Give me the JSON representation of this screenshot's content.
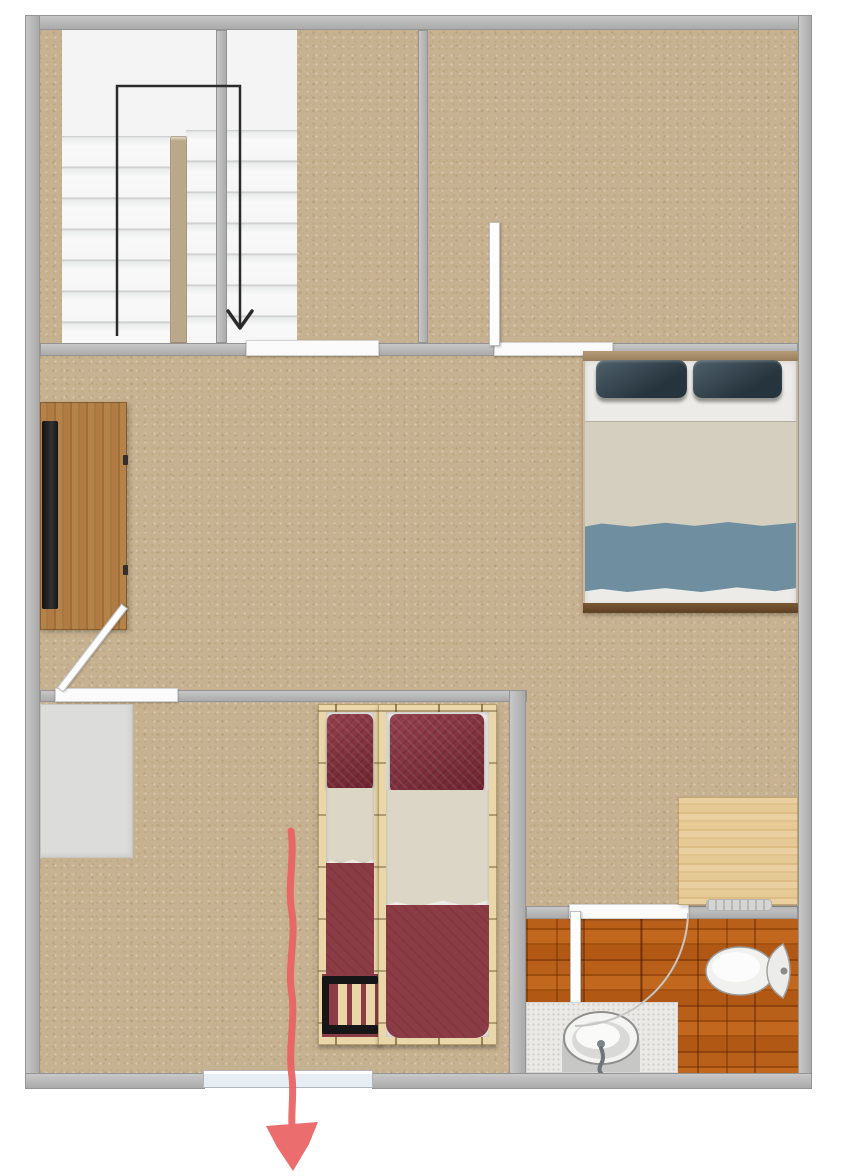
{
  "document": {
    "kind": "floor-plan",
    "view": "top-down",
    "visible_text": []
  },
  "colors": {
    "carpet": "#c6b190",
    "wall": "#b3b3b3",
    "wall_edge": "#949494",
    "stair_bg": "#f4f4f4",
    "stair_divider": "#bba888",
    "sill": "#fbfbfb",
    "window_glass": "#e6eef3",
    "closet": "#dcdcda",
    "desk_wood": "#b07d40",
    "tv": "#1d1d1d",
    "pine_desk": "#e6c893",
    "vent": "#d5d5d3",
    "bed_head": "#a98e6d",
    "bed_foot": "#6e4e2e",
    "mattress": "#ecebe7",
    "pillow_slate": "#37454e",
    "blanket_beige": "#d5cfc0",
    "blanket_blue": "#6f8fa0",
    "twin_frame": "#e9d7a9",
    "twin_pillow": "#82323d",
    "twin_sheet": "#dcd6c7",
    "twin_blanket": "#8b3c45",
    "ladder": "#161616",
    "bath_wood": "#ab5312",
    "counter": "#ebe9e5",
    "porcelain": "#efefed",
    "guide": "#2b2b2b",
    "arrow_red": "#ea6262"
  },
  "stairs": {
    "flights": 2,
    "treads_per_flight": 7,
    "shape": "U-return",
    "direction_arrow": "down"
  },
  "areas": [
    {
      "id": "staircase",
      "floor": "white"
    },
    {
      "id": "upper-hall",
      "floor": "carpet"
    },
    {
      "id": "bedroom-top-right",
      "floor": "carpet"
    },
    {
      "id": "central-living-area",
      "floor": "carpet"
    },
    {
      "id": "bedroom-bottom-twin",
      "floor": "carpet"
    },
    {
      "id": "bathroom",
      "floor": "wood-planks"
    }
  ],
  "doors": [
    {
      "id": "bedroom-top-door",
      "state": "open",
      "leaf": "shown"
    },
    {
      "id": "living-to-bottom-room-door",
      "state": "half-open-diagonal",
      "leaf": "shown"
    },
    {
      "id": "bathroom-door",
      "state": "open",
      "swing_arc_visible": true
    }
  ],
  "windows": [
    {
      "id": "south-window",
      "wall": "bottom"
    }
  ],
  "furniture": [
    {
      "id": "closet-wardrobe",
      "room": "bedroom-bottom-twin"
    },
    {
      "id": "tv-sideboard",
      "room": "central-living-area",
      "items_on_top": [
        "tv"
      ]
    },
    {
      "id": "double-bed",
      "room": "central-living-area",
      "pillows": 2,
      "pillow_color_ref": "pillow_slate"
    },
    {
      "id": "twin-bed-left",
      "room": "bedroom-bottom-twin",
      "pillows": 1,
      "ladder_at_foot": true
    },
    {
      "id": "twin-bed-right",
      "room": "bedroom-bottom-twin",
      "pillows": 1
    },
    {
      "id": "desk-pine",
      "room": "central-living-area"
    },
    {
      "id": "heater-vent",
      "room": "central-living-area"
    },
    {
      "id": "sink-vanity",
      "room": "bathroom"
    },
    {
      "id": "toilet",
      "room": "bathroom"
    }
  ],
  "annotations": [
    {
      "id": "stair-path-line",
      "color_ref": "guide",
      "arrow": "down"
    },
    {
      "id": "exit-arrow",
      "color_ref": "arrow_red",
      "direction": "down",
      "style": "hand-drawn"
    }
  ]
}
